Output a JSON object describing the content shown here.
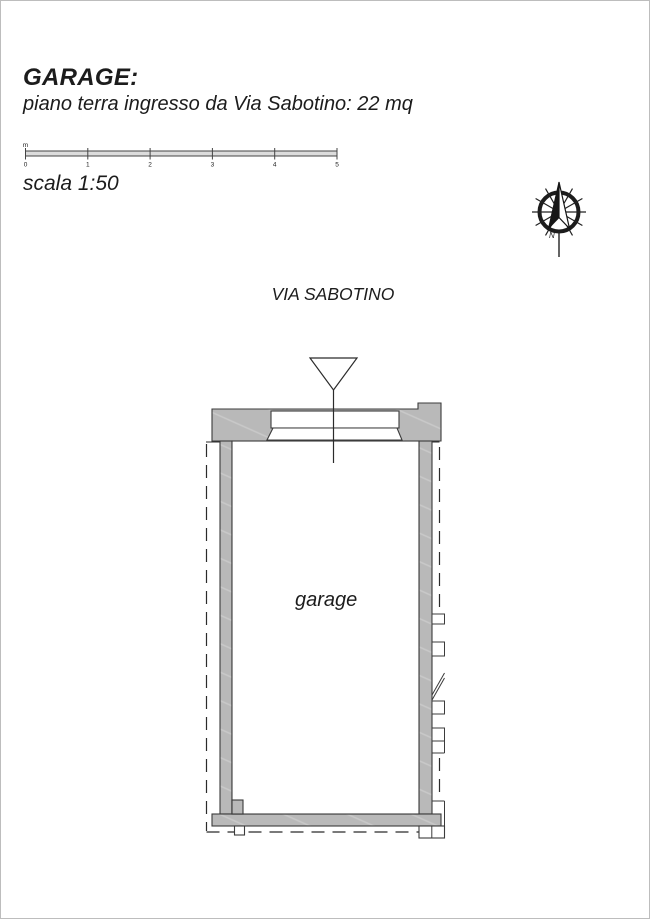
{
  "header": {
    "title": "GARAGE:",
    "subtitle": "piano terra ingresso da Via Sabotino: 22 mq"
  },
  "scale_bar": {
    "unit": "m",
    "ticks": [
      "0",
      "1",
      "2",
      "3",
      "4",
      "5"
    ],
    "label": "scala 1:50"
  },
  "plan": {
    "street_label": "VIA SABOTINO",
    "room_label": "garage"
  },
  "compass": {
    "north_label": "N"
  },
  "colors": {
    "wall_fill": "#b9b9b9",
    "wall_hatch": "#c9c9c9",
    "line": "#3b3b3b",
    "background": "#ffffff"
  }
}
